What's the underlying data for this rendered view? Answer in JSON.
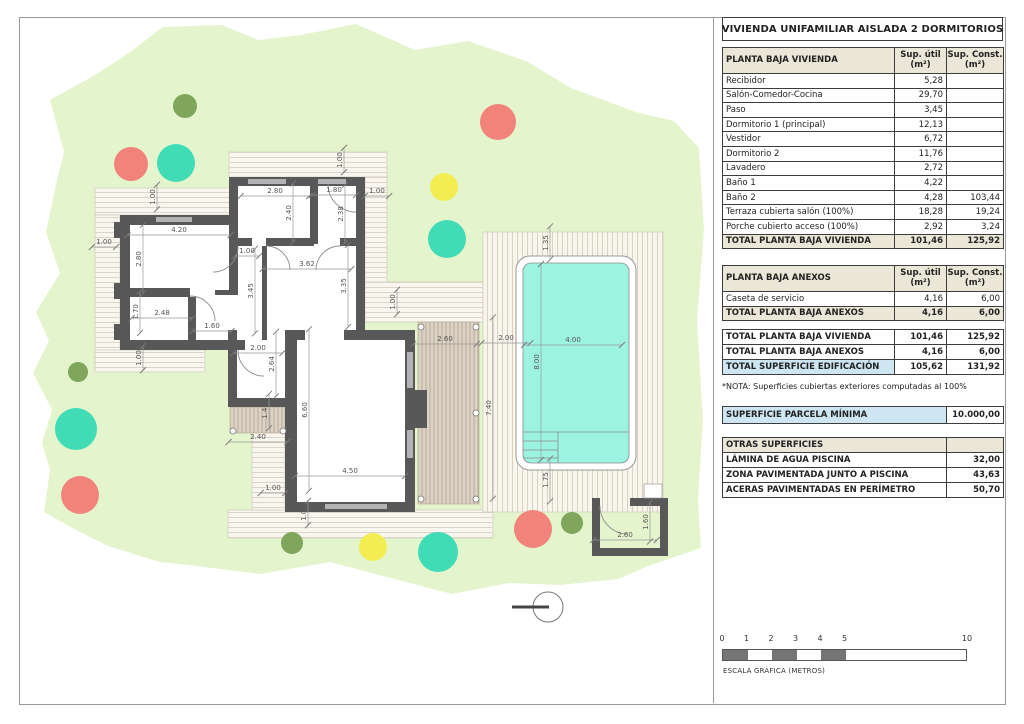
{
  "sheet": {
    "title": "VIVIENDA UNIFAMILIAR AISLADA 2 DORMITORIOS",
    "nota": "*NOTA: Superficies cubiertas exteriores computadas al 100%",
    "scalebar": {
      "caption": "ESCALA GRÁFICA (METROS)",
      "ticks": [
        0,
        1,
        2,
        3,
        4,
        5,
        10
      ],
      "px_per_m": 24.5,
      "filled_segments": [
        [
          0,
          1
        ],
        [
          2,
          3
        ],
        [
          4,
          5
        ]
      ]
    }
  },
  "tables": {
    "planta_vivienda": {
      "cols": [
        172,
        52,
        57
      ],
      "header": [
        "PLANTA BAJA VIVIENDA",
        "Sup. útil\n(m²)",
        "Sup. Const.\n(m²)"
      ],
      "rows": [
        [
          "Recibidor",
          "5,28",
          ""
        ],
        [
          "Salón-Comedor-Cocina",
          "29,70",
          ""
        ],
        [
          "Paso",
          "3,45",
          ""
        ],
        [
          "Dormitorio 1 (principal)",
          "12,13",
          ""
        ],
        [
          "Vestidor",
          "6,72",
          ""
        ],
        [
          "Dormitorio 2",
          "11,76",
          ""
        ],
        [
          "Lavadero",
          "2,72",
          ""
        ],
        [
          "Baño 1",
          "4,22",
          ""
        ],
        [
          "Baño 2",
          "4,28",
          "103,44"
        ],
        [
          "Terraza cubierta salón (100%)",
          "18,28",
          "19,24"
        ],
        [
          "Porche cubierto acceso (100%)",
          "2,92",
          "3,24"
        ],
        [
          "TOTAL PLANTA BAJA VIVIENDA",
          "101,46",
          "125,92"
        ]
      ],
      "cls": [
        "",
        "",
        "",
        "",
        "",
        "",
        "",
        "",
        "",
        "",
        "",
        "total"
      ]
    },
    "planta_anexos": {
      "cols": [
        172,
        52,
        57
      ],
      "header": [
        "PLANTA BAJA ANEXOS",
        "Sup. útil\n(m²)",
        "Sup. Const.\n(m²)"
      ],
      "rows": [
        [
          "Caseta de servicio",
          "4,16",
          "6,00"
        ],
        [
          "TOTAL PLANTA BAJA ANEXOS",
          "4,16",
          "6,00"
        ]
      ],
      "cls": [
        "",
        "total"
      ]
    },
    "resumen": {
      "cols": [
        172,
        52,
        57
      ],
      "header": null,
      "rows": [
        [
          "TOTAL PLANTA BAJA VIVIENDA",
          "101,46",
          "125,92"
        ],
        [
          "TOTAL PLANTA BAJA ANEXOS",
          "4,16",
          "6,00"
        ],
        [
          "TOTAL SUPERFICIE EDIFICACIÓN",
          "105,62",
          "131,92"
        ]
      ],
      "cls": [
        "bold",
        "bold",
        "hl"
      ]
    },
    "parcela": {
      "cols": [
        224,
        57
      ],
      "header": null,
      "rows": [
        [
          "SUPERFICIE PARCELA MÍNIMA",
          "10.000,00"
        ]
      ],
      "cls": [
        "parc"
      ]
    },
    "otras": {
      "cols": [
        224,
        57
      ],
      "header": null,
      "rows": [
        [
          "OTRAS SUPERFICIES",
          ""
        ],
        [
          "LÁMINA DE AGUA PISCINA",
          "32,00"
        ],
        [
          "ZONA PAVIMENTADA JUNTO A PISCINA",
          "43,63"
        ],
        [
          "ACERAS PAVIMENTADAS EN PERÍMETRO",
          "50,70"
        ]
      ],
      "cls": [
        "head",
        "bold",
        "bold",
        "bold"
      ]
    }
  },
  "plan": {
    "dimensions": [
      {
        "x": 340,
        "y": 160,
        "v": "1.00",
        "o": "v"
      },
      {
        "x": 275,
        "y": 192,
        "v": "2.80",
        "o": "h"
      },
      {
        "x": 334,
        "y": 191,
        "v": "1.80",
        "o": "h"
      },
      {
        "x": 377,
        "y": 192,
        "v": "1.00",
        "o": "h"
      },
      {
        "x": 289,
        "y": 213,
        "v": "2.40",
        "o": "v"
      },
      {
        "x": 341,
        "y": 214,
        "v": "2.38",
        "o": "v"
      },
      {
        "x": 153,
        "y": 197,
        "v": "1.00",
        "o": "v"
      },
      {
        "x": 179,
        "y": 231,
        "v": "4.20",
        "o": "h"
      },
      {
        "x": 104,
        "y": 243,
        "v": "1.00",
        "o": "h"
      },
      {
        "x": 139,
        "y": 259,
        "v": "2.80",
        "o": "v"
      },
      {
        "x": 247,
        "y": 252,
        "v": "1.00",
        "o": "h"
      },
      {
        "x": 307,
        "y": 265,
        "v": "3.62",
        "o": "h"
      },
      {
        "x": 251,
        "y": 291,
        "v": "3.45",
        "o": "v"
      },
      {
        "x": 344,
        "y": 286,
        "v": "3.35",
        "o": "v"
      },
      {
        "x": 136,
        "y": 312,
        "v": "1.70",
        "o": "v"
      },
      {
        "x": 162,
        "y": 314,
        "v": "2.48",
        "o": "h"
      },
      {
        "x": 212,
        "y": 327,
        "v": "1.60",
        "o": "h"
      },
      {
        "x": 139,
        "y": 358,
        "v": "1.00",
        "o": "v"
      },
      {
        "x": 258,
        "y": 349,
        "v": "2.00",
        "o": "h"
      },
      {
        "x": 272,
        "y": 364,
        "v": "2.64",
        "o": "v"
      },
      {
        "x": 265,
        "y": 411,
        "v": "1.40",
        "o": "v"
      },
      {
        "x": 258,
        "y": 438,
        "v": "2.40",
        "o": "h"
      },
      {
        "x": 305,
        "y": 410,
        "v": "6.60",
        "o": "v"
      },
      {
        "x": 350,
        "y": 472,
        "v": "4.50",
        "o": "h"
      },
      {
        "x": 273,
        "y": 489,
        "v": "1.00",
        "o": "h"
      },
      {
        "x": 304,
        "y": 513,
        "v": "1.00",
        "o": "v"
      },
      {
        "x": 393,
        "y": 302,
        "v": "1.00",
        "o": "v"
      },
      {
        "x": 445,
        "y": 340,
        "v": "2.60",
        "o": "h"
      },
      {
        "x": 506,
        "y": 339,
        "v": "2.00",
        "o": "h"
      },
      {
        "x": 573,
        "y": 341,
        "v": "4.00",
        "o": "h"
      },
      {
        "x": 537,
        "y": 362,
        "v": "8.00",
        "o": "v"
      },
      {
        "x": 489,
        "y": 408,
        "v": "7.40",
        "o": "v"
      },
      {
        "x": 546,
        "y": 243,
        "v": "1.35",
        "o": "v"
      },
      {
        "x": 546,
        "y": 480,
        "v": "1.75",
        "o": "v"
      },
      {
        "x": 625,
        "y": 536,
        "v": "2.60",
        "o": "h"
      },
      {
        "x": 646,
        "y": 522,
        "v": "1.60",
        "o": "v"
      }
    ],
    "trees": [
      {
        "x": 185,
        "y": 106,
        "r": 12,
        "c": "olive"
      },
      {
        "x": 498,
        "y": 122,
        "r": 18,
        "c": "red"
      },
      {
        "x": 131,
        "y": 164,
        "r": 17,
        "c": "red"
      },
      {
        "x": 176,
        "y": 163,
        "r": 19,
        "c": "teal"
      },
      {
        "x": 444,
        "y": 187,
        "r": 14,
        "c": "yellow"
      },
      {
        "x": 447,
        "y": 239,
        "r": 19,
        "c": "teal"
      },
      {
        "x": 78,
        "y": 372,
        "r": 10,
        "c": "olive"
      },
      {
        "x": 76,
        "y": 429,
        "r": 21,
        "c": "teal"
      },
      {
        "x": 80,
        "y": 495,
        "r": 19,
        "c": "red"
      },
      {
        "x": 292,
        "y": 543,
        "r": 11,
        "c": "olive"
      },
      {
        "x": 373,
        "y": 547,
        "r": 14,
        "c": "yellow"
      },
      {
        "x": 438,
        "y": 552,
        "r": 20,
        "c": "teal"
      },
      {
        "x": 533,
        "y": 529,
        "r": 19,
        "c": "red"
      },
      {
        "x": 572,
        "y": 523,
        "r": 11,
        "c": "olive"
      }
    ],
    "tree_colors": {
      "red": "#F2837B",
      "teal": "#40DCB6",
      "yellow": "#F2EE52",
      "olive": "#7FA65A"
    },
    "colors": {
      "garden": "#E4F5CE",
      "pool_water": "#9DF3E1",
      "wall": "#585858",
      "deck_bg": "#F8F6EE",
      "deck_line": "#DAD5C6",
      "terrace_bg": "#DCD2C5",
      "terrace_line": "#B9AB98",
      "accent_blue": "#CDE6F1",
      "header_beige": "#EAE6D8"
    }
  }
}
